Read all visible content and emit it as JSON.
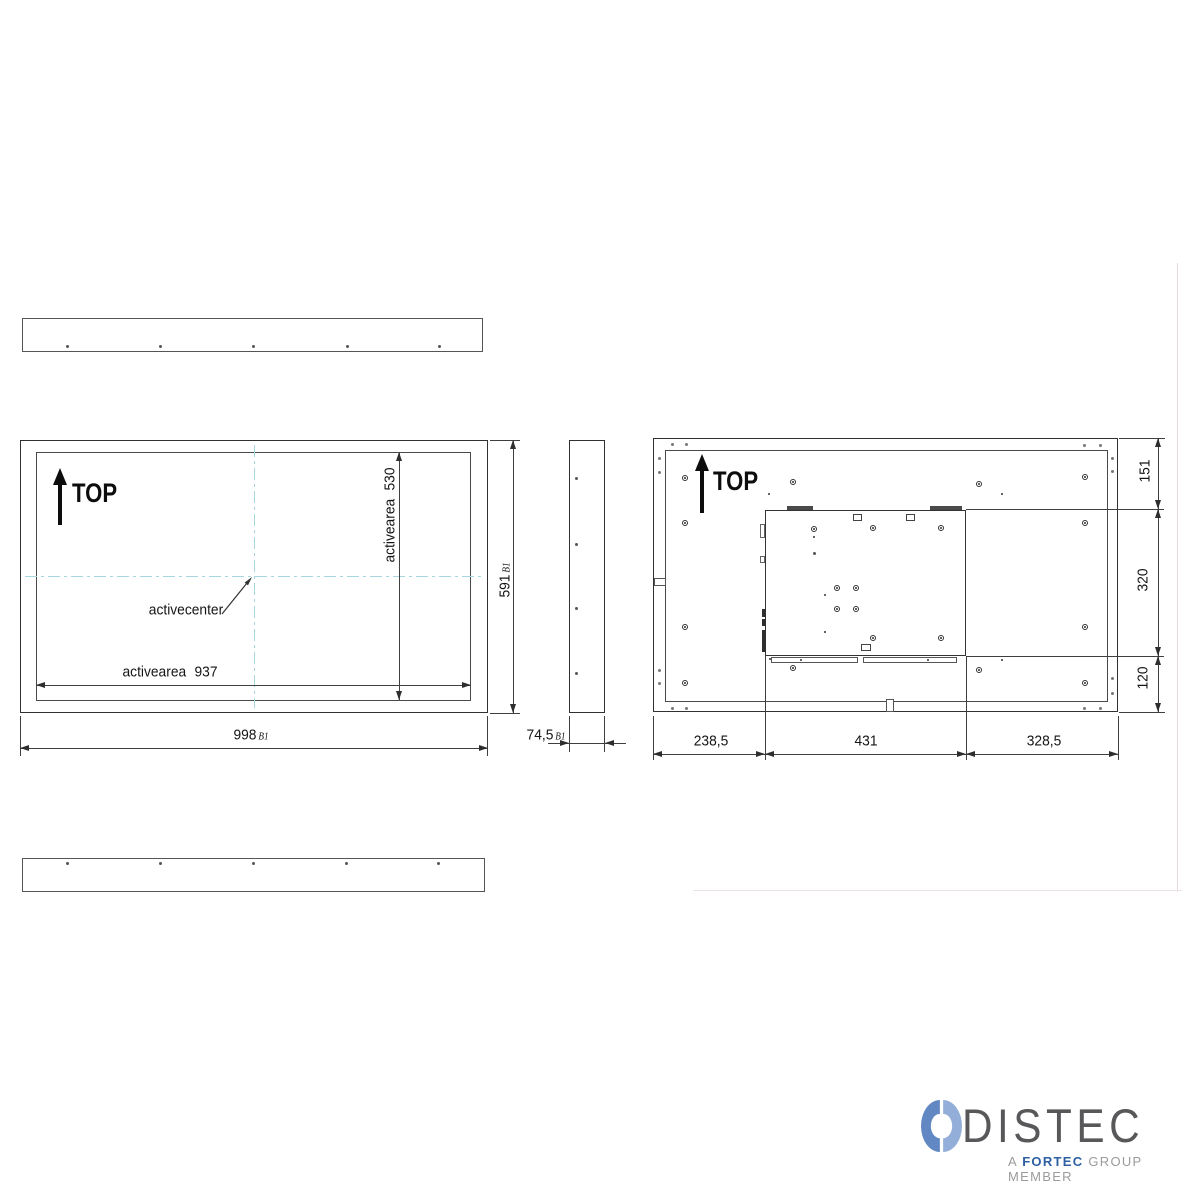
{
  "views": {
    "front": {
      "top_label": "TOP",
      "activearea_height_label": "activearea",
      "activearea_height_value": "530",
      "activearea_width_label": "activearea",
      "activearea_width_value": "937",
      "activecenter_label": "activecenter",
      "width_value": "998",
      "width_suffix": "B1",
      "height_value": "591",
      "height_suffix": "B1"
    },
    "side": {
      "depth_value": "74,5",
      "depth_suffix": "B1"
    },
    "back": {
      "top_label": "TOP",
      "right_dims": [
        "151",
        "320",
        "120"
      ],
      "bottom_dims": [
        "238,5",
        "431",
        "328,5"
      ]
    }
  },
  "logo": {
    "brand": "DISTEC",
    "tagline_a": "A",
    "tagline_fortec": "FORTEC",
    "tagline_rest": "GROUP MEMBER",
    "colors": {
      "brand_text": "#58585a",
      "fortec_blue": "#2e5fa3",
      "icon_left_blue": "#6188c2",
      "icon_right_blue": "#93aed8",
      "drawing_line": "#3f3f3f",
      "crosshair_blue": "#a6d7de"
    }
  }
}
